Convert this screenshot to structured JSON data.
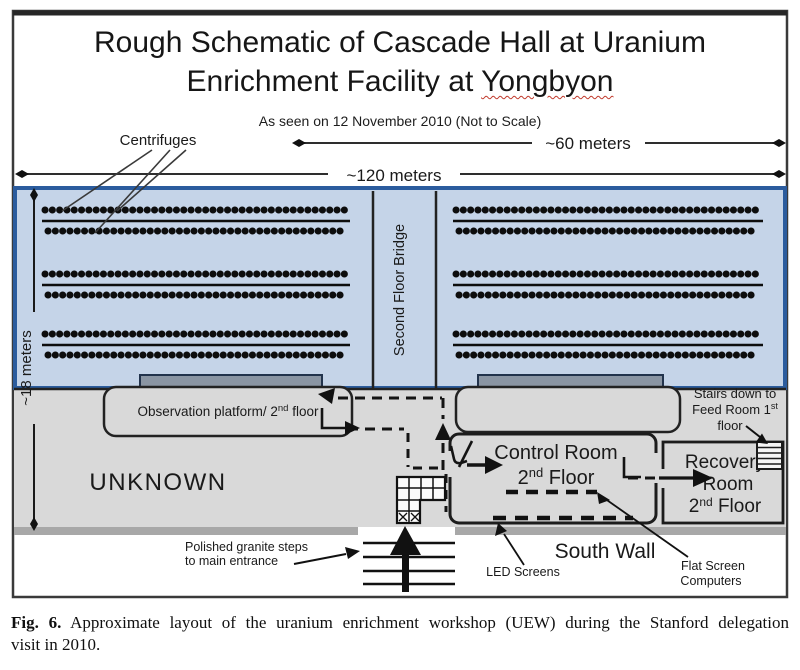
{
  "title": {
    "line1": "Rough Schematic of Cascade Hall at Uranium",
    "line2_pre": "Enrichment Facility at ",
    "line2_underlined": "Yongbyon"
  },
  "subtitle": "As seen on 12 November 2010 (Not to Scale)",
  "measurements": {
    "width_total": "~120 meters",
    "width_right": "~60 meters",
    "height_left": "~18 meters"
  },
  "labels": {
    "centrifuges": "Centrifuges",
    "bridge": "Second Floor Bridge",
    "observation_platform": {
      "pre": "Observation platform/ 2",
      "sup": "nd",
      "post": " floor"
    },
    "unknown": "UNKNOWN",
    "control_room": {
      "line1": "Control Room",
      "l2pre": "2",
      "l2sup": "nd",
      "l2post": " Floor"
    },
    "recovery_room": {
      "line1": "Recovery",
      "line2": "Room",
      "l3pre": "2",
      "l3sup": "nd",
      "l3post": " Floor"
    },
    "stairs_note": {
      "line1": "Stairs down to",
      "l2pre": "Feed Room 1",
      "l2sup": "st",
      "line3": "floor"
    },
    "granite_steps": {
      "line1": "Polished granite steps",
      "line2": "to main entrance"
    },
    "led_screens": "LED Screens",
    "south_wall": "South Wall",
    "flat_screens": {
      "line1": "Flat Screen",
      "line2": "Computers"
    }
  },
  "caption": {
    "fig": "Fig. 6.",
    "line1": "Approximate layout of the uranium enrichment workshop (UEW) during the Stanford delegation",
    "line2": "visit in 2010."
  },
  "colors": {
    "hall_fill": "#c5d4e8",
    "hall_border": "#2b5c9e",
    "floor_fill": "#d9d9d9",
    "south_wall_bar": "#a8a8a8",
    "window_bar": "#8a95a3",
    "spellcheck_underline": "#c0392b",
    "ink": "#141414"
  }
}
